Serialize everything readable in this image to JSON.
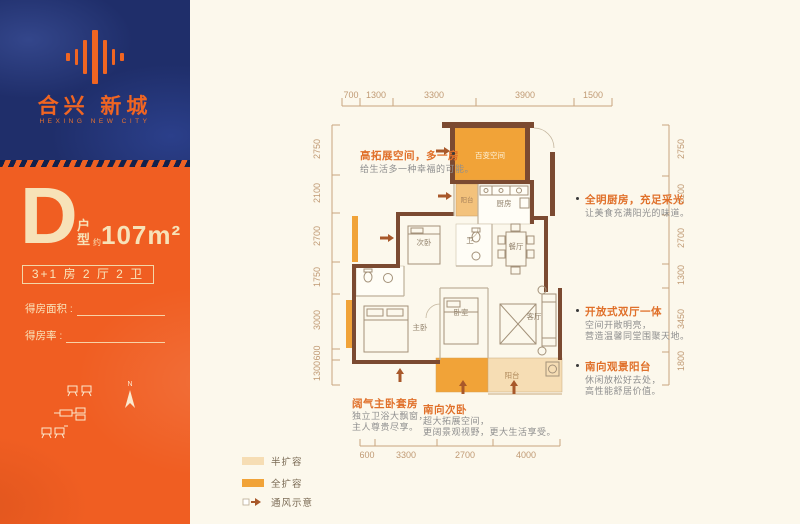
{
  "brand": {
    "cn": "合兴 新城",
    "en": "HEXING NEW CITY"
  },
  "unit": {
    "letter": "D",
    "type_vert": [
      "户",
      "型"
    ],
    "approx": "约",
    "area": "107m²",
    "layout": "3+1 房 2 厅 2 卫",
    "field_area": "得房面积 :",
    "field_rate": "得房率 :",
    "compass": "N"
  },
  "dims": {
    "top": [
      "700",
      "1300",
      "3300",
      "3900",
      "1500"
    ],
    "left": [
      "2750",
      "2100",
      "2700",
      "1750",
      "3000",
      "600",
      "1300"
    ],
    "right": [
      "2750",
      "2100",
      "2700",
      "1300",
      "3450",
      "1800"
    ],
    "bottom": [
      "600",
      "3300",
      "2700",
      "4000"
    ]
  },
  "rooms": {
    "flex": "百变空间",
    "balcony_top": "阳台",
    "kitchen": "厨房",
    "bath": "卫",
    "dining": "餐厅",
    "bed2": "次卧",
    "master": "主卧",
    "bed3": "卧室",
    "living": "客厅",
    "balcony_bottom": "阳台"
  },
  "callouts": [
    {
      "title": "高拓展空间，多一房",
      "line1": "给生活多一种幸福的可能。",
      "line2": ""
    },
    {
      "title": "全明厨房，充足采光",
      "line1": "让美食充满阳光的味道。",
      "line2": ""
    },
    {
      "title": "开放式双厅一体",
      "line1": "空间开敞明亮，",
      "line2": "营造温馨同堂围聚天地。"
    },
    {
      "title": "南向观景阳台",
      "line1": "休闲放松好去处，",
      "line2": "高性能舒居价值。"
    },
    {
      "title": "阔气主卧套房",
      "line1": "独立卫浴大飘窗，",
      "line2": "主人尊贵尽享。"
    },
    {
      "title": "南向次卧",
      "line1": "超大拓展空间，",
      "line2": "更阔景观视野，更大生活享受。"
    }
  ],
  "legend": {
    "half": "半扩容",
    "full": "全扩容",
    "vent": "通风示意"
  },
  "colors": {
    "navy": "#1f2e6a",
    "orange": "#f05e22",
    "cream_text": "#f7e2b8",
    "page_bg": "#fcf8ec",
    "plan_orange": "#f1a338",
    "plan_peach": "#f6ddb4",
    "wall_brown": "#7b4a31",
    "accent": "#e0702a",
    "dim_text": "#c09a74"
  }
}
